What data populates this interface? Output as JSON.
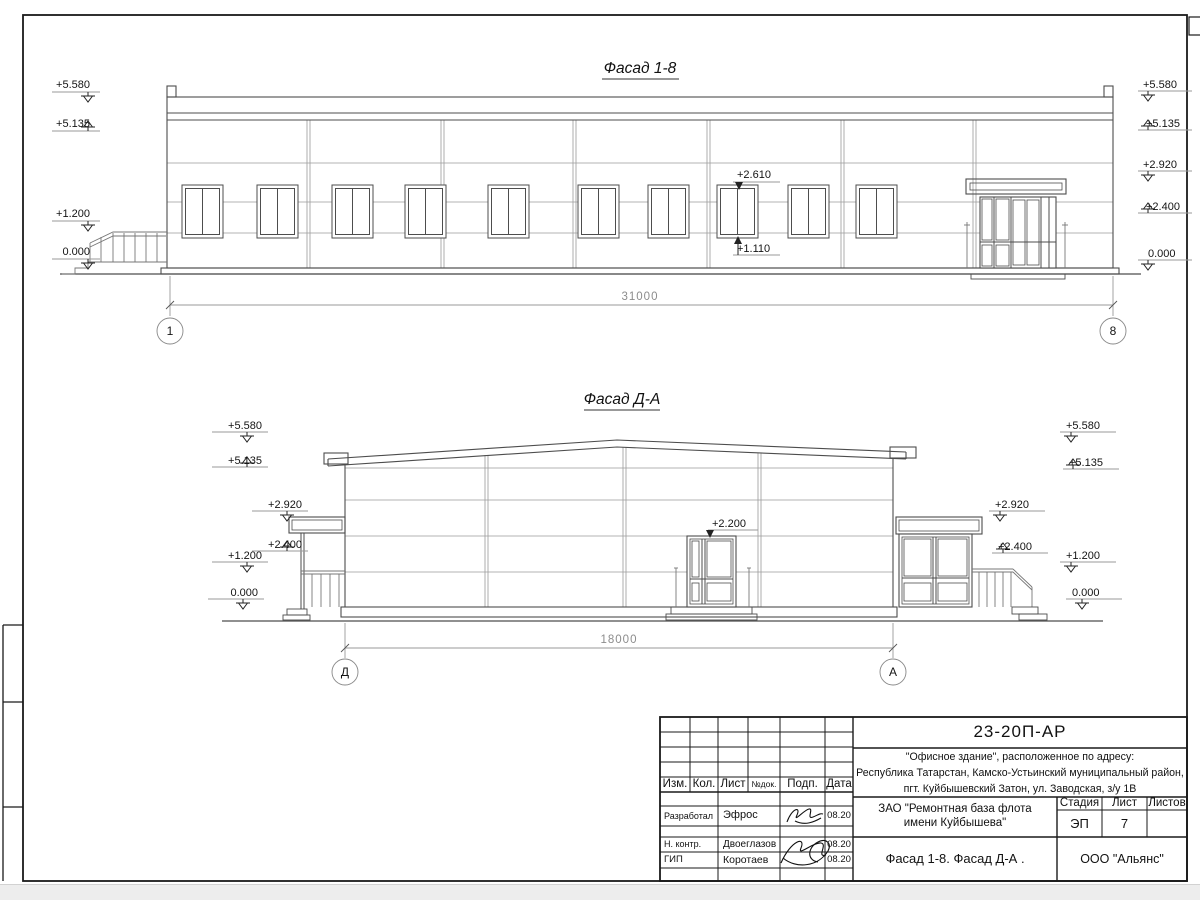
{
  "facade_1_8": {
    "title": "Фасад 1-8",
    "axis_left": "1",
    "axis_right": "8",
    "dimension": "31000",
    "marks_left": [
      "+5.580",
      "+5.135",
      "+1.200",
      "0.000"
    ],
    "marks_right": [
      "+5.580",
      "+5.135",
      "+2.920",
      "+2.400",
      "0.000"
    ],
    "window_mark_top": "+2.610",
    "window_mark_bottom": "+1.110"
  },
  "facade_d_a": {
    "title": "Фасад Д-А",
    "axis_left": "Д",
    "axis_right": "А",
    "dimension": "18000",
    "marks_left": [
      "+5.580",
      "+5.135",
      "+2.920",
      "+2.400",
      "+1.200",
      "0.000"
    ],
    "marks_right": [
      "+5.580",
      "+5.135",
      "+2.920",
      "+2.400",
      "+1.200",
      "0.000"
    ],
    "door_mark": "+2.200"
  },
  "title_block": {
    "doc_number": "23-20П-АР",
    "address_line1": "\"Офисное здание\", расположенное по адресу:",
    "address_line2": "Республика Татарстан, Камско-Устьинский муниципальный район,",
    "address_line3": "пгт. Куйбышевский Затон, ул. Заводская, з/у 1В",
    "client_line1": "ЗАО \"Ремонтная база флота",
    "client_line2": "имени Куйбышева\"",
    "sheet_name": "Фасад 1-8. Фасад Д-А .",
    "company": "ООО \"Альянс\"",
    "stage_label": "Стадия",
    "list_label": "Лист",
    "listov_label": "Листов",
    "stage_value": "ЭП",
    "list_value": "7",
    "col_izm": "Изм.",
    "col_kol": "Кол.",
    "col_list": "Лист",
    "col_ndoc": "№док.",
    "col_podp": "Подп.",
    "col_data": "Дата",
    "rows": [
      {
        "role": "Разработал",
        "name": "Эфрос",
        "date": "08.20"
      },
      {
        "role": "Н. контр.",
        "name": "Двоеглазов",
        "date": "08.20"
      },
      {
        "role": "ГИП",
        "name": "Коротаев",
        "date": "08.20"
      }
    ]
  }
}
